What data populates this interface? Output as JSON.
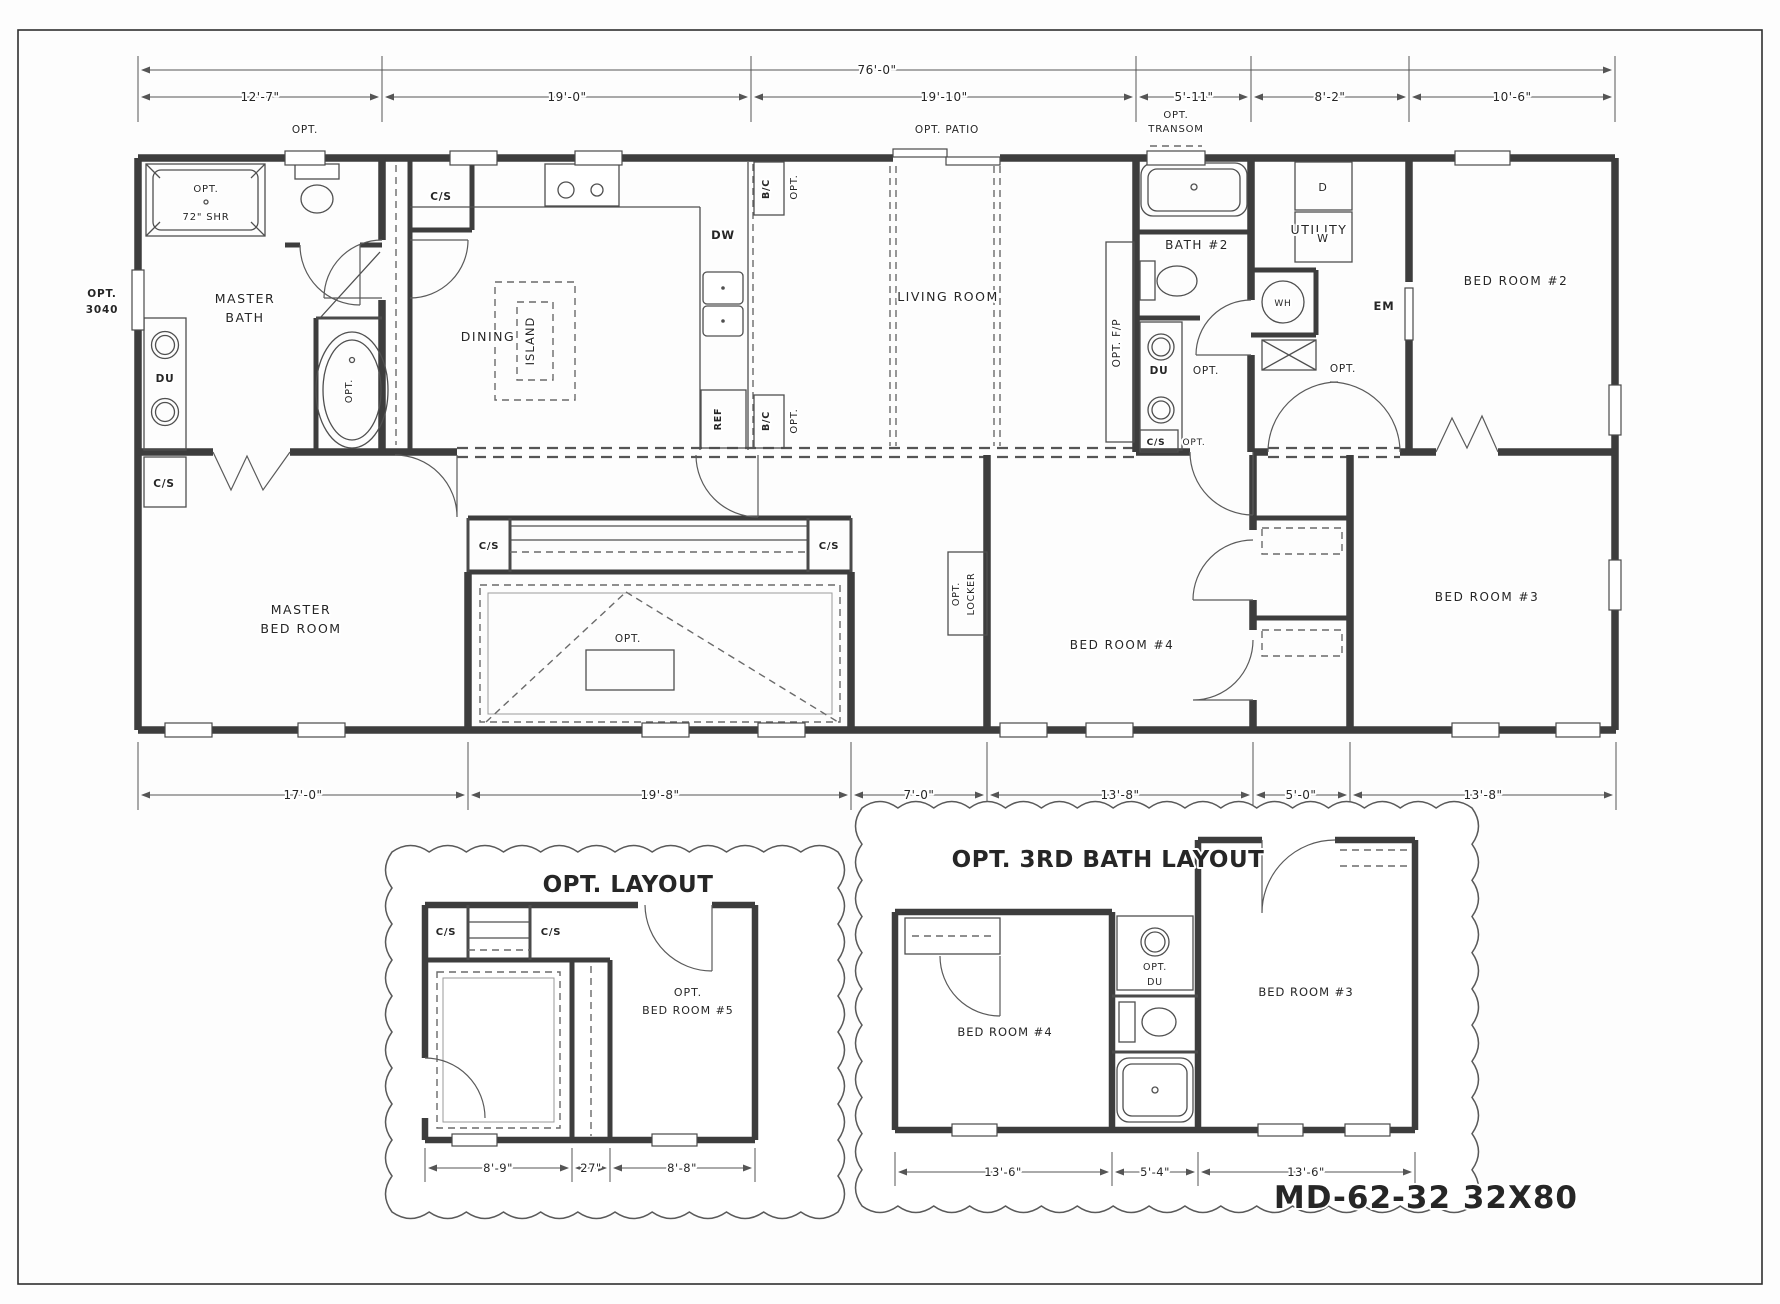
{
  "sheet": {
    "type": "manufactured-home floor plan",
    "model": "MD-62-32 32X80"
  },
  "dimensions": {
    "top_overall": "76'-0\"",
    "top_segments": [
      "12'-7\"",
      "19'-0\"",
      "19'-10\"",
      "5'-11\"",
      "8'-2\"",
      "10'-6\""
    ],
    "bottom_segments": [
      "17'-0\"",
      "19'-8\"",
      "7'-0\"",
      "13'-8\"",
      "5'-0\"",
      "13'-8\""
    ],
    "opt_layout_segments": [
      "8'-9\"",
      "27\"",
      "8'-8\""
    ],
    "opt_3rd_bath_segments": [
      "13'-6\"",
      "5'-4\"",
      "13'-6\""
    ]
  },
  "rooms": [
    "MASTER BATH",
    "DINING",
    "LIVING ROOM",
    "BATH #2",
    "UTILITY",
    "BED ROOM #2",
    "MASTER BED ROOM",
    "BED ROOM #4",
    "BED ROOM #3",
    "OPT. BED ROOM #5"
  ],
  "inset_titles": [
    "OPT. LAYOUT",
    "OPT. 3RD BATH LAYOUT"
  ],
  "labels": [
    {
      "n": "dim-overall-width",
      "t": "76'-0\"",
      "x": 877,
      "y": 74,
      "s": 12,
      "ls": 0.5
    },
    {
      "n": "dim-top-1",
      "t": "12'-7\"",
      "x": 260,
      "y": 101,
      "s": 12,
      "ls": 0.5
    },
    {
      "n": "dim-top-2",
      "t": "19'-0\"",
      "x": 567,
      "y": 101,
      "s": 12,
      "ls": 0.5
    },
    {
      "n": "dim-top-3",
      "t": "19'-10\"",
      "x": 944,
      "y": 101,
      "s": 12,
      "ls": 0.5
    },
    {
      "n": "dim-top-4",
      "t": "5'-11\"",
      "x": 1194,
      "y": 101,
      "s": 12,
      "ls": 0.5
    },
    {
      "n": "dim-top-5",
      "t": "8'-2\"",
      "x": 1330,
      "y": 101,
      "s": 12,
      "ls": 0.5
    },
    {
      "n": "dim-top-6",
      "t": "10'-6\"",
      "x": 1512,
      "y": 101,
      "s": 12,
      "ls": 0.5
    },
    {
      "n": "opt-window-masterbath",
      "t": "OPT.",
      "x": 305,
      "y": 133,
      "s": 10.5
    },
    {
      "n": "opt-shower",
      "t": "OPT.",
      "x": 206,
      "y": 192,
      "s": 10
    },
    {
      "n": "shower-size",
      "t": "72\" SHR",
      "x": 206,
      "y": 220,
      "s": 10
    },
    {
      "n": "opt-3040-line1",
      "t": "OPT.",
      "x": 102,
      "y": 297,
      "s": 10.5,
      "w": 700
    },
    {
      "n": "opt-3040-line2",
      "t": "3040",
      "x": 102,
      "y": 313,
      "s": 10.5,
      "w": 700
    },
    {
      "n": "room-master-bath-1",
      "t": "MASTER",
      "x": 245,
      "y": 303,
      "s": 12.5,
      "w": 500,
      "ls": 1.5
    },
    {
      "n": "room-master-bath-2",
      "t": "BATH",
      "x": 245,
      "y": 322,
      "s": 12.5,
      "w": 500,
      "ls": 1.5
    },
    {
      "n": "fixture-du-master",
      "t": "DU",
      "x": 165,
      "y": 382,
      "s": 10.5,
      "w": 700
    },
    {
      "n": "fixture-cs-master",
      "t": "C/S",
      "x": 164,
      "y": 487,
      "s": 10.5,
      "w": 700
    },
    {
      "n": "opt-tub",
      "t": "OPT.",
      "x": 352,
      "y": 391,
      "s": 9.5,
      "r": -90
    },
    {
      "n": "fixture-cs-dining",
      "t": "C/S",
      "x": 441,
      "y": 200,
      "s": 10.5,
      "w": 700
    },
    {
      "n": "room-dining",
      "t": "DINING",
      "x": 488,
      "y": 341,
      "s": 12.5,
      "w": 500,
      "ls": 1.5
    },
    {
      "n": "fixture-island",
      "t": "ISLAND",
      "x": 534,
      "y": 341,
      "s": 11.5,
      "r": -90,
      "ls": 1
    },
    {
      "n": "fixture-dw",
      "t": "DW",
      "x": 723,
      "y": 239,
      "s": 11.5,
      "w": 700
    },
    {
      "n": "fixture-bc-upper",
      "t": "B/C",
      "x": 769,
      "y": 189,
      "s": 9.5,
      "w": 700,
      "r": -90
    },
    {
      "n": "opt-bc-upper",
      "t": "OPT.",
      "x": 797,
      "y": 187,
      "s": 10,
      "r": -90
    },
    {
      "n": "fixture-ref",
      "t": "REF",
      "x": 721,
      "y": 419,
      "s": 9.5,
      "w": 700,
      "r": -90
    },
    {
      "n": "fixture-bc-lower",
      "t": "B/C",
      "x": 769,
      "y": 421,
      "s": 9.5,
      "w": 700,
      "r": -90
    },
    {
      "n": "opt-bc-lower",
      "t": "OPT.",
      "x": 797,
      "y": 421,
      "s": 10,
      "r": -90
    },
    {
      "n": "opt-patio",
      "t": "OPT. PATIO",
      "x": 947,
      "y": 133,
      "s": 10.5,
      "w": 500
    },
    {
      "n": "room-living",
      "t": "LIVING ROOM",
      "x": 948,
      "y": 301,
      "s": 12.5,
      "w": 500,
      "ls": 1.5
    },
    {
      "n": "opt-transom-1",
      "t": "OPT.",
      "x": 1176,
      "y": 118,
      "s": 10,
      "w": 500
    },
    {
      "n": "opt-transom-2",
      "t": "TRANSOM",
      "x": 1176,
      "y": 132,
      "s": 10,
      "w": 500
    },
    {
      "n": "opt-fireplace",
      "t": "OPT. F/P",
      "x": 1120,
      "y": 343,
      "s": 10.5,
      "w": 500,
      "r": -90
    },
    {
      "n": "room-bath2",
      "t": "BATH #2",
      "x": 1197,
      "y": 249,
      "s": 12,
      "w": 500,
      "ls": 1.5
    },
    {
      "n": "fixture-du-bath2",
      "t": "DU",
      "x": 1159,
      "y": 374,
      "s": 10.5,
      "w": 700
    },
    {
      "n": "opt-du-bath2",
      "t": "OPT.",
      "x": 1206,
      "y": 374,
      "s": 10.5
    },
    {
      "n": "fixture-cs-bath2",
      "t": "C/S",
      "x": 1156,
      "y": 445,
      "s": 9,
      "w": 700
    },
    {
      "n": "opt-cs-bath2",
      "t": "OPT.",
      "x": 1194,
      "y": 445,
      "s": 9
    },
    {
      "n": "room-utility",
      "t": "UTILITY",
      "x": 1319,
      "y": 234,
      "s": 12.5,
      "w": 500,
      "ls": 1.5
    },
    {
      "n": "fixture-wh",
      "t": "WH",
      "x": 1283,
      "y": 306,
      "s": 9,
      "w": 500
    },
    {
      "n": "fixture-dryer",
      "t": "D",
      "x": 1323,
      "y": 191,
      "s": 11,
      "w": 500
    },
    {
      "n": "fixture-washer",
      "t": "W",
      "x": 1323,
      "y": 242,
      "s": 11,
      "w": 500
    },
    {
      "n": "fixture-em",
      "t": "EM",
      "x": 1384,
      "y": 310,
      "s": 11.5,
      "w": 700
    },
    {
      "n": "opt-utility-door",
      "t": "OPT.",
      "x": 1343,
      "y": 372,
      "s": 10.5,
      "w": 500
    },
    {
      "n": "room-bed2",
      "t": "BED ROOM #2",
      "x": 1516,
      "y": 285,
      "s": 12,
      "w": 500,
      "ls": 1.5
    },
    {
      "n": "room-master-bed-1",
      "t": "MASTER",
      "x": 301,
      "y": 614,
      "s": 12.5,
      "w": 500,
      "ls": 1.5
    },
    {
      "n": "room-master-bed-2",
      "t": "BED ROOM",
      "x": 301,
      "y": 633,
      "s": 12.5,
      "w": 500,
      "ls": 1.5
    },
    {
      "n": "fixture-cs-wardrobe-left",
      "t": "C/S",
      "x": 489,
      "y": 549,
      "s": 10,
      "w": 700
    },
    {
      "n": "fixture-cs-wardrobe-right",
      "t": "C/S",
      "x": 829,
      "y": 549,
      "s": 10,
      "w": 700
    },
    {
      "n": "opt-room-box",
      "t": "OPT.",
      "x": 628,
      "y": 642,
      "s": 10.5,
      "w": 500
    },
    {
      "n": "opt-locker-1",
      "t": "OPT.",
      "x": 959,
      "y": 594,
      "s": 9.5,
      "w": 500,
      "r": -90
    },
    {
      "n": "opt-locker-2",
      "t": "LOCKER",
      "x": 974,
      "y": 594,
      "s": 9.5,
      "w": 500,
      "r": -90
    },
    {
      "n": "room-bed4",
      "t": "BED ROOM #4",
      "x": 1122,
      "y": 649,
      "s": 12,
      "w": 500,
      "ls": 1.5
    },
    {
      "n": "room-bed3",
      "t": "BED ROOM #3",
      "x": 1487,
      "y": 601,
      "s": 12,
      "w": 500,
      "ls": 1.5
    },
    {
      "n": "dim-bottom-1",
      "t": "17'-0\"",
      "x": 303,
      "y": 799,
      "s": 12,
      "ls": 0.5
    },
    {
      "n": "dim-bottom-2",
      "t": "19'-8\"",
      "x": 660,
      "y": 799,
      "s": 12,
      "ls": 0.5
    },
    {
      "n": "dim-bottom-3",
      "t": "7'-0\"",
      "x": 919,
      "y": 799,
      "s": 12,
      "ls": 0.5
    },
    {
      "n": "dim-bottom-4",
      "t": "13'-8\"",
      "x": 1120,
      "y": 799,
      "s": 12,
      "ls": 0.5
    },
    {
      "n": "dim-bottom-5",
      "t": "5'-0\"",
      "x": 1301,
      "y": 799,
      "s": 12,
      "ls": 0.5
    },
    {
      "n": "dim-bottom-6",
      "t": "13'-8\"",
      "x": 1483,
      "y": 799,
      "s": 12,
      "ls": 0.5
    },
    {
      "n": "inset1-title",
      "t": "OPT. LAYOUT",
      "x": 628,
      "y": 892,
      "s": 23,
      "w": 700,
      "ls": 0.5
    },
    {
      "n": "i1-cs-left",
      "t": "C/S",
      "x": 446,
      "y": 935,
      "s": 10,
      "w": 700
    },
    {
      "n": "i1-cs-right",
      "t": "C/S",
      "x": 551,
      "y": 935,
      "s": 10,
      "w": 700
    },
    {
      "n": "i1-bed5-1",
      "t": "OPT.",
      "x": 688,
      "y": 996,
      "s": 11,
      "w": 500,
      "ls": 1
    },
    {
      "n": "i1-bed5-2",
      "t": "BED ROOM #5",
      "x": 688,
      "y": 1014,
      "s": 11,
      "w": 500,
      "ls": 1
    },
    {
      "n": "i1-dim-1",
      "t": "8'-9\"",
      "x": 498,
      "y": 1172,
      "s": 11.5,
      "ls": 0.5
    },
    {
      "n": "i1-dim-2",
      "t": "27\"",
      "x": 591,
      "y": 1172,
      "s": 11.5,
      "ls": 0.5
    },
    {
      "n": "i1-dim-3",
      "t": "8'-8\"",
      "x": 682,
      "y": 1172,
      "s": 11.5,
      "ls": 0.5
    },
    {
      "n": "inset2-title",
      "t": "OPT. 3RD BATH LAYOUT",
      "x": 1108,
      "y": 867,
      "s": 23,
      "w": 700,
      "ls": 0.5
    },
    {
      "n": "i2-bed4",
      "t": "BED ROOM #4",
      "x": 1005,
      "y": 1036,
      "s": 11.5,
      "w": 500,
      "ls": 1
    },
    {
      "n": "i2-du-1",
      "t": "OPT.",
      "x": 1155,
      "y": 970,
      "s": 9.5,
      "w": 500
    },
    {
      "n": "i2-du-2",
      "t": "DU",
      "x": 1155,
      "y": 985,
      "s": 9.5,
      "w": 500
    },
    {
      "n": "i2-bed3",
      "t": "BED ROOM #3",
      "x": 1306,
      "y": 996,
      "s": 11.5,
      "w": 500,
      "ls": 1
    },
    {
      "n": "i2-dim-1",
      "t": "13'-6\"",
      "x": 1003,
      "y": 1176,
      "s": 11.5,
      "ls": 0.5
    },
    {
      "n": "i2-dim-2",
      "t": "5'-4\"",
      "x": 1155,
      "y": 1176,
      "s": 11.5,
      "ls": 0.5
    },
    {
      "n": "i2-dim-3",
      "t": "13'-6\"",
      "x": 1306,
      "y": 1176,
      "s": 11.5,
      "ls": 0.5
    },
    {
      "n": "model-number",
      "t": "MD-62-32 32X80",
      "x": 1578,
      "y": 1208,
      "s": 31,
      "w": 800,
      "a": "end",
      "ls": 1
    }
  ]
}
